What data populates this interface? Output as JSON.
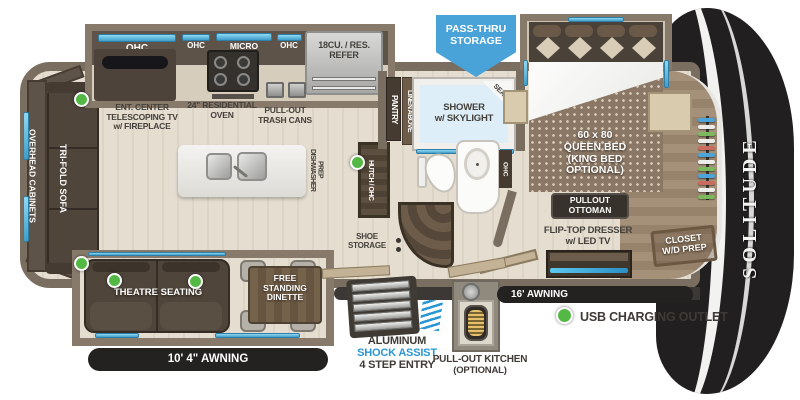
{
  "brand": "SOLITUDE",
  "banner": {
    "pass_thru": "PASS-THRU\nSTORAGE"
  },
  "kitchen": {
    "ohc_left": "OHC",
    "ohc_mid": "OHC",
    "micro": "MICRO",
    "ohc_right": "OHC",
    "refer": "18CU. / RES.\nREFER",
    "ent_center": "ENT. CENTER\nTELESCOPING TV\nw/ FIREPLACE",
    "oven": "24\" RESIDENTIAL\nOVEN",
    "trash": "PULL-OUT\nTRASH CANS",
    "dishwasher_prep": "DISHWASHER\nPREP"
  },
  "living": {
    "overhead_cabinets": "OVERHEAD CABINETS",
    "tri_fold_sofa": "TRI-FOLD SOFA",
    "theatre_seating": "THEATRE SEATING",
    "dinette": "FREE\nSTANDING\nDINETTE"
  },
  "bath": {
    "pantry": "PANTRY",
    "linen": "LINEN ABOVE",
    "shower": "SHOWER\nw/ SKYLIGHT",
    "seat": "SEAT",
    "ohc": "OHC",
    "hutch": "HUTCH / OHC",
    "shoe_storage": "SHOE\nSTORAGE"
  },
  "bedroom": {
    "bed": "60 x 80\nQUEEN BED\n(KING BED\nOPTIONAL)",
    "ottoman": "PULLOUT\nOTTOMAN",
    "dresser": "FLIP-TOP DRESSER\nw/ LED TV",
    "closet": "CLOSET\nW/D PREP",
    "hanger_colors": [
      "#4da4d8",
      "#ececea",
      "#7cb85c",
      "#ececea",
      "#c96b5e",
      "#4da4d8",
      "#ececea",
      "#7cb85c",
      "#4da4d8",
      "#c96b5e",
      "#ececea",
      "#7cb85c"
    ]
  },
  "entry": {
    "aluminum": "ALUMINUM",
    "shock_assist": "SHOCK ASSIST",
    "step_entry": "4 STEP ENTRY",
    "pull_out_kitchen": "PULL-OUT KITCHEN",
    "optional": "(OPTIONAL)"
  },
  "awnings": {
    "left": "10' 4\"  AWNING",
    "right": "16' AWNING"
  },
  "legend": {
    "usb": "USB CHARGING OUTLET"
  },
  "colors": {
    "pass_thru_blue": "#4aa3d8",
    "usb_green": "#54b845",
    "shock_blue": "#2997d4",
    "awning_black": "#232220"
  }
}
